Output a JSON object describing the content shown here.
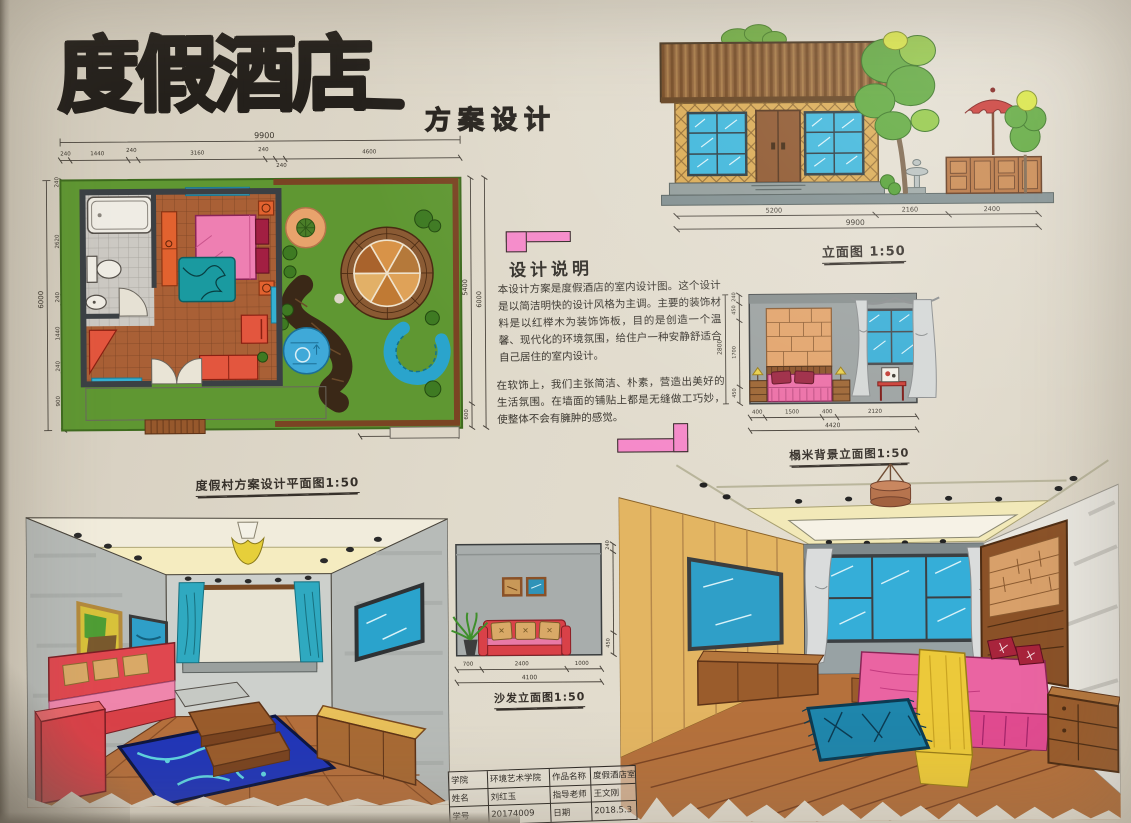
{
  "title": {
    "main": "度假酒店",
    "sub": "方案设计"
  },
  "design_notes": {
    "heading": "设计说明",
    "para1": "本设计方案是度假酒店的室内设计图。这个设计是以简洁明快的设计风格为主调。主要的装饰材料是以红榉木为装饰饰板，目的是创造一个温馨、现代化的环境氛围，给住户一种安静舒适合自己居住的室内设计。",
    "para2": "在软饰上，我们主张简洁、朴素，营造出美好的生活氛围。在墙面的铺贴上都是无缝做工巧妙，使整体不会有臃肿的感觉。"
  },
  "floor_plan": {
    "caption": "度假村方案设计平面图1:50",
    "top_total": "9900",
    "top_segs": [
      "240",
      "1440",
      "240",
      "3160",
      "240",
      "240",
      "4600"
    ],
    "left_total": "6000",
    "left_segs": [
      "240",
      "2620",
      "240",
      "1440",
      "240",
      "900"
    ],
    "right_inner": "5400",
    "right_total": "6000",
    "right_small": "600",
    "bottom_seg": "2800"
  },
  "building_elevation": {
    "caption": "立面图 1:50",
    "segs": [
      "5200",
      "2160",
      "2400"
    ],
    "total": "9900"
  },
  "interior_elevation": {
    "caption": "榻米背景立面图1:50",
    "bottom_segs": [
      "400",
      "1500",
      "400",
      "2120"
    ],
    "bottom_total": "4420",
    "left_segs": [
      "240",
      "450",
      "1700",
      "450"
    ],
    "left_total": "2800"
  },
  "sofa_elevation": {
    "caption": "沙发立面图1:50",
    "bottom_segs": [
      "700",
      "2400",
      "1000"
    ],
    "bottom_total": "4100",
    "right_segs": [
      "240",
      "450"
    ]
  },
  "title_block": {
    "rows": [
      {
        "label1": "学院",
        "value1": "环境艺术学院",
        "label2": "作品名称",
        "value2": "度假酒店室内设计"
      },
      {
        "label1": "姓名",
        "value1": "刘红玉",
        "label2": "指导老师",
        "value2": "王文刚"
      },
      {
        "label1": "学号",
        "value1": "20174009",
        "label2": "日期",
        "value2": "2018.5.3"
      }
    ]
  }
}
